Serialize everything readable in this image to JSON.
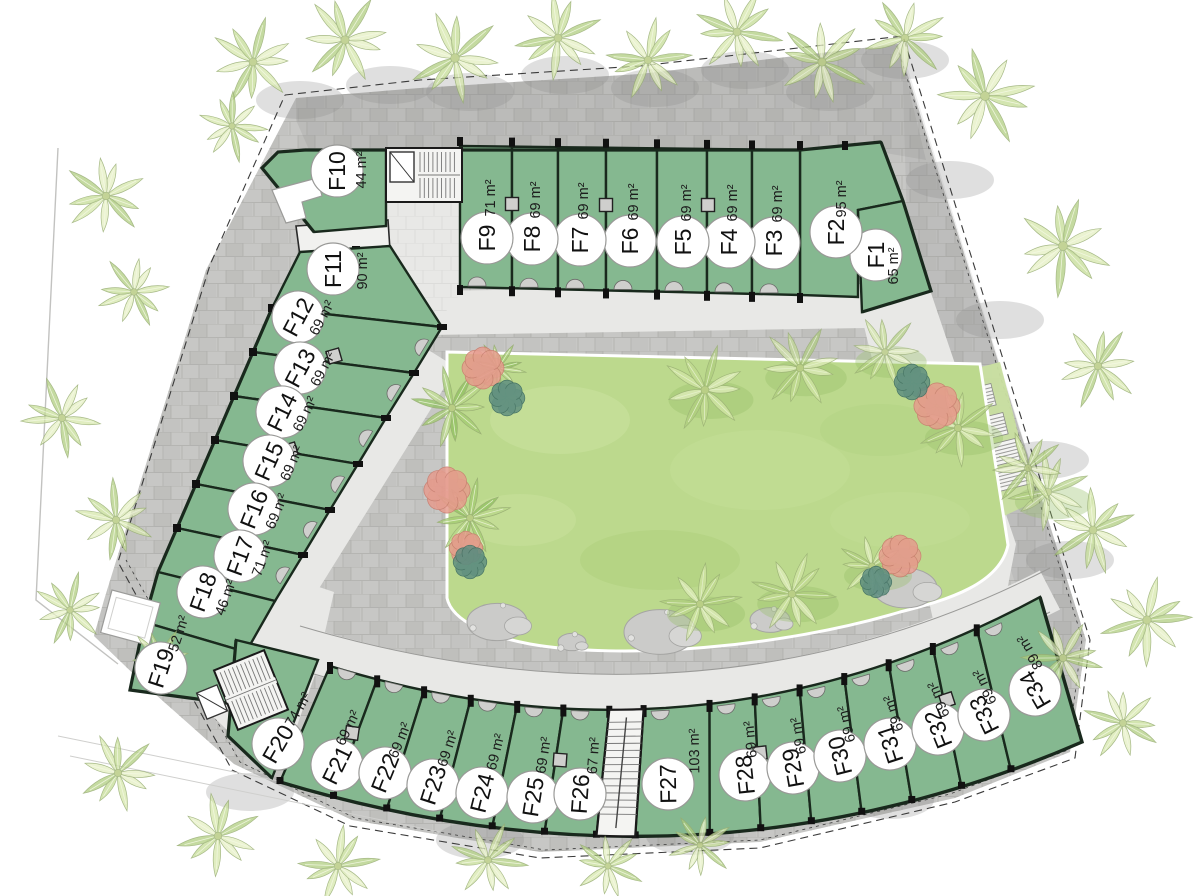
{
  "plan": {
    "area_unit": "m²",
    "units": [
      {
        "id": "F1",
        "area": "65 m²"
      },
      {
        "id": "F2",
        "area": "95 m²"
      },
      {
        "id": "F3",
        "area": "69 m²"
      },
      {
        "id": "F4",
        "area": "69 m²"
      },
      {
        "id": "F5",
        "area": "69 m²"
      },
      {
        "id": "F6",
        "area": "69 m²"
      },
      {
        "id": "F7",
        "area": "69 m²"
      },
      {
        "id": "F8",
        "area": "69 m²"
      },
      {
        "id": "F9",
        "area": "71 m²"
      },
      {
        "id": "F10",
        "area": "44 m²"
      },
      {
        "id": "F11",
        "area": "90 m²"
      },
      {
        "id": "F12",
        "area": "69 m²"
      },
      {
        "id": "F13",
        "area": "69 m²"
      },
      {
        "id": "F14",
        "area": "69 m²"
      },
      {
        "id": "F15",
        "area": "69 m²"
      },
      {
        "id": "F16",
        "area": "69 m²"
      },
      {
        "id": "F17",
        "area": "71 m²"
      },
      {
        "id": "F18",
        "area": "46 m²"
      },
      {
        "id": "F19",
        "area": "52 m²"
      },
      {
        "id": "F20",
        "area": "74 m²"
      },
      {
        "id": "F21",
        "area": "69 m²"
      },
      {
        "id": "F22",
        "area": "69 m²"
      },
      {
        "id": "F23",
        "area": "69 m²"
      },
      {
        "id": "F24",
        "area": "69 m²"
      },
      {
        "id": "F25",
        "area": "69 m²"
      },
      {
        "id": "F26",
        "area": "67 m²"
      },
      {
        "id": "F27",
        "area": "103 m²"
      },
      {
        "id": "F28",
        "area": "69 m²"
      },
      {
        "id": "F29",
        "area": "69 m²"
      },
      {
        "id": "F30",
        "area": "69 m²"
      },
      {
        "id": "F31",
        "area": "69 m²"
      },
      {
        "id": "F32",
        "area": "69 m²"
      },
      {
        "id": "F33",
        "area": "69 m²"
      },
      {
        "id": "F34",
        "area": "89 m²"
      }
    ],
    "colors": {
      "unit_fill": "#85b890",
      "unit_wall": "#19291d",
      "lawn": "#bcd98d",
      "paving_outer": "#c7c7c5",
      "paving_walkway": "#e8e8e6",
      "label_circle": "#ffffff",
      "label_text": "#111111",
      "tree_light": "#e3eec0",
      "tree_dark": "#aecd7d",
      "flower_pink": "#e59a8c",
      "bush_teal": "#5d8d80"
    }
  }
}
